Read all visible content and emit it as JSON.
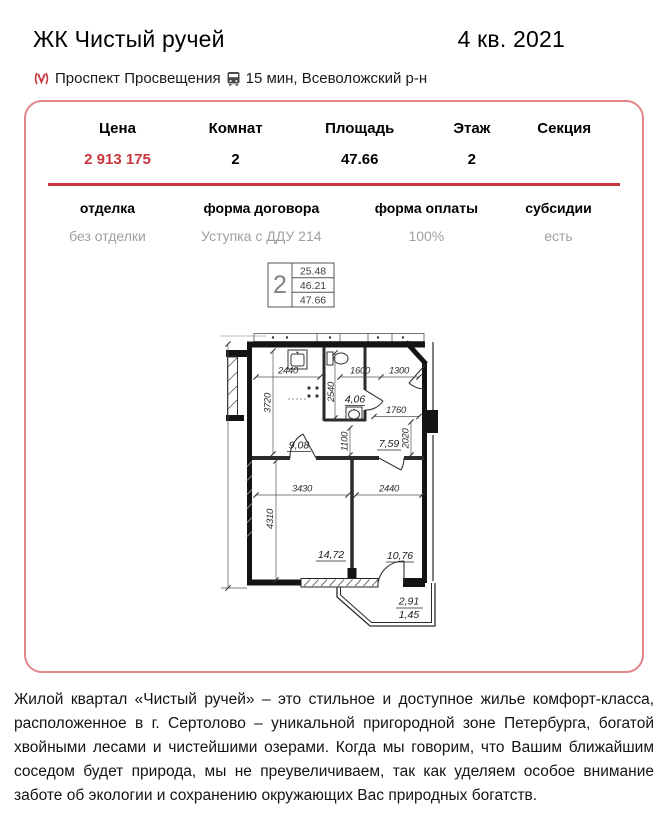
{
  "header": {
    "title": "ЖК Чистый ручей",
    "quarter": "4 кв. 2021"
  },
  "location": {
    "metro_station": "Проспект Просвещения",
    "commute": "15 мин, Всеволожский р-н"
  },
  "summary": {
    "columns": [
      {
        "label": "Цена",
        "value": "2 913 175"
      },
      {
        "label": "Комнат",
        "value": "2"
      },
      {
        "label": "Площадь",
        "value": "47.66"
      },
      {
        "label": "Этаж",
        "value": "2"
      },
      {
        "label": "Секция",
        "value": ""
      }
    ],
    "details": [
      {
        "label": "отделка",
        "value": "без отделки"
      },
      {
        "label": "форма договора",
        "value": "Уступка с ДДУ 214"
      },
      {
        "label": "форма оплаты",
        "value": "100%"
      },
      {
        "label": "субсидии",
        "value": "есть"
      }
    ]
  },
  "plan": {
    "stamp": {
      "rooms": "2",
      "living_area": "25.48",
      "apartment_area": "46.21",
      "total_area": "47.66"
    },
    "areas": {
      "kitchen": "9,08",
      "bathroom": "4,06",
      "hall": "7,59",
      "living_room": "14,72",
      "bedroom": "10,76",
      "balcony": "2,91",
      "balcony_reduced": "1,45"
    },
    "dims": {
      "kitchen_w": "2440",
      "kitchen_h": "3720",
      "bath_h": "2540",
      "hall_top_left": "1600",
      "hall_top_right": "1300",
      "hall_mid": "1760",
      "hall_h": "2020",
      "passage_h": "1100",
      "living_w": "3430",
      "bedroom_w": "2440",
      "living_h": "4310"
    }
  },
  "description": "Жилой квартал «Чистый ручей» – это стильное и доступное жилье комфорт-класса, расположенное в г. Сертолово – уникальной пригородной зоне Петербурга, богатой хвойными лесами и чистейшими озерами. Когда мы говорим, что Вашим ближайшим соседом будет природа, мы не преувеличиваем, так как уделяем особое внимание заботе об экологии и сохранению окружающих Вас природных богатств.",
  "colors": {
    "accent": "#c9353c",
    "card_border": "#e0868a",
    "muted": "#9f9f9f"
  }
}
